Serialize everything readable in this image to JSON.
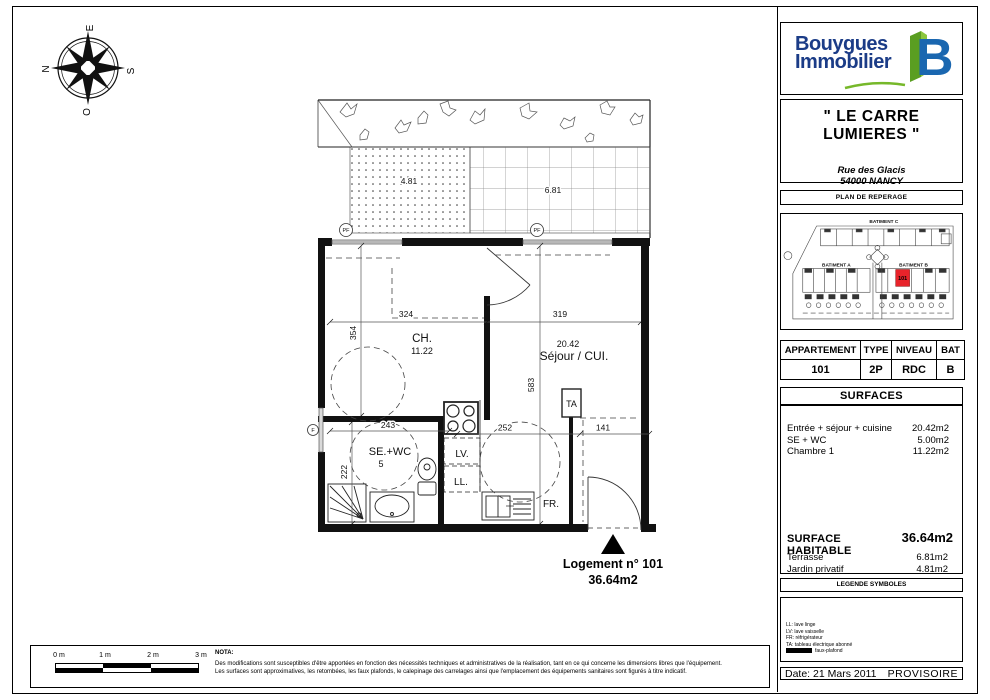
{
  "compass": {
    "north": "N",
    "south": "S",
    "east": "E",
    "west": "O"
  },
  "plan": {
    "garden_area": "4.81",
    "terrace_area": "6.81",
    "window_pf": "PF",
    "window_f": "F",
    "rooms": {
      "bedroom_name": "CH.",
      "bedroom_area": "11.22",
      "living_area": "20.42",
      "living_name": "Séjour / CUI.",
      "bath_name": "SE.+WC",
      "bath_area": "5",
      "dishwasher": "LV.",
      "washer": "LL.",
      "fridge": "FR.",
      "panel": "TA"
    },
    "dims": {
      "d324": "324",
      "d319": "319",
      "d354": "354",
      "d583": "583",
      "d243": "243",
      "d252": "252",
      "d141": "141",
      "d222": "222"
    },
    "unit_label": "Logement n° 101",
    "unit_area": "36.64m2"
  },
  "panel": {
    "logo": {
      "line1": "Bouygues",
      "line2": "Immobilier",
      "mark": "B"
    },
    "colors": {
      "logo_navy": "#1b3c87",
      "logo_blue": "#1a67b0",
      "logo_green": "#76b82a",
      "unit_red": "#e8232a"
    },
    "project": {
      "title": "\" LE CARRE LUMIERES \"",
      "address1": "Rue des Glacis",
      "address2": "54000 NANCY"
    },
    "site": {
      "header": "PLAN DE REPERAGE",
      "batiment_a": "BATIMENT A",
      "batiment_b": "BATIMENT B",
      "batiment_c": "BATIMENT C",
      "unit": "101"
    },
    "apartment_table": {
      "headers": [
        "APPARTEMENT",
        "TYPE",
        "NIVEAU",
        "BAT"
      ],
      "values": [
        "101",
        "2P",
        "RDC",
        "B"
      ]
    },
    "surfaces": {
      "header": "SURFACES",
      "rows": [
        {
          "label": "Entrée + séjour + cuisine",
          "value": "20.42m2"
        },
        {
          "label": "SE + WC",
          "value": "5.00m2"
        },
        {
          "label": "Chambre 1",
          "value": "11.22m2"
        }
      ],
      "habitable_label": "SURFACE HABITABLE",
      "habitable_value": "36.64m2",
      "extra_rows": [
        {
          "label": "Terrasse",
          "value": "6.81m2"
        },
        {
          "label": "Jardin privatif",
          "value": "4.81m2"
        }
      ]
    },
    "legend": {
      "header": "LEGENDE SYMBOLES",
      "items": [
        "LL: lave linge",
        "LV: lave vaisselle",
        "FR: réfrigérateur",
        "TA: tableau électrique abonné"
      ],
      "fauxplafond": "faux-plafond"
    },
    "footer": {
      "date": "Date: 21 Mars 2011",
      "status": "PROVISOIRE"
    }
  },
  "footer_strip": {
    "scale_labels": [
      "0 m",
      "1 m",
      "2 m",
      "3 m"
    ],
    "nota_title": "NOTA:",
    "nota_line1": "Des modifications sont susceptibles d'être apportées en fonction des nécessités techniques et administratives de la réalisation, tant en ce qui concerne les dimensions libres que l'équipement.",
    "nota_line2": "Les surfaces sont approximatives, les retombées, les faux plafonds, le calepinage des carrelages ainsi que l'emplacement des équipements sanitaires sont figurés à titre indicatif."
  }
}
